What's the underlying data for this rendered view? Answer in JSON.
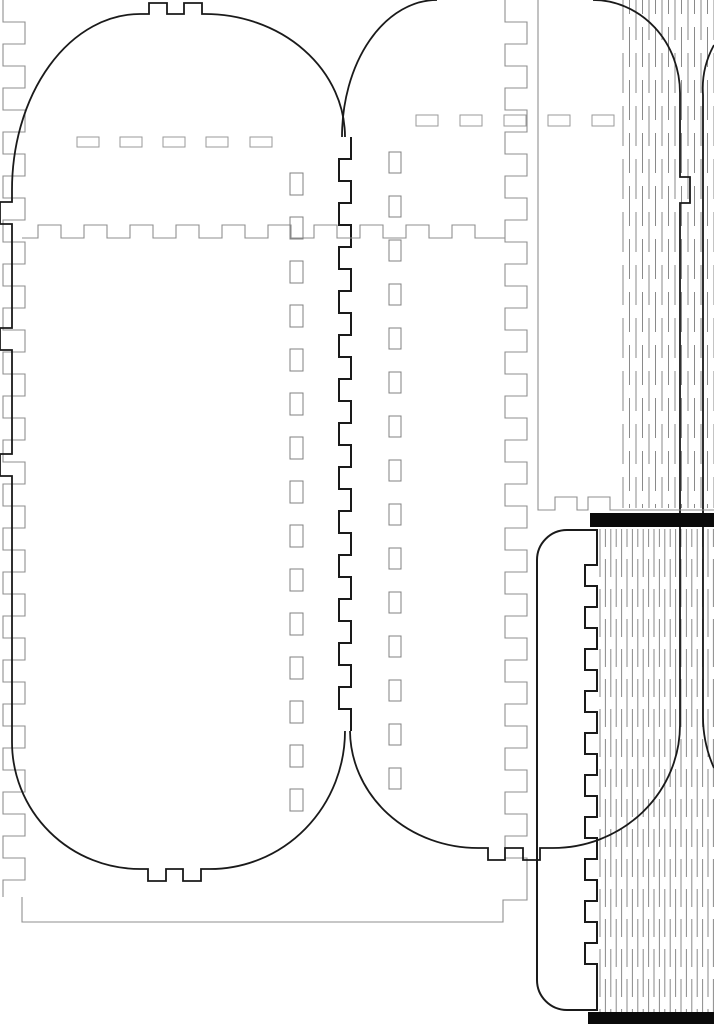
{
  "canvas": {
    "width": 714,
    "height": 1024,
    "background": "#ffffff"
  },
  "colors": {
    "cut_primary": "#1a1a1a",
    "cut_secondary": "#8f8f8f",
    "hinge_line": "#8a8a8a",
    "slot_bar_fill": "#0a0a0a"
  },
  "paths": {
    "left_stadium_top": "M12 190 A128 176 0 0 1 140 14 H149 V3 H167 V14 H184 V3 H202 V14 H205 A140 123 0 0 1 345 137",
    "left_stadium_left": "M12 190 V202 H0 V224 H12 V328 H0 V350 H12 V454 H0 V476 H12 V742",
    "left_stadium_bottom": "M345 731 A135 138 0 0 1 210 869 H201 V881 H183 V869 H166 V881 H148 V869 H140 A128 127 0 0 1 12 742",
    "center_panel": "M342 137 A95 137 0 0 1 437 0 M593 0 A87 93 0 0 1 680 93 V177 H690 V203 H680 V725 A127 123 0 0 1 553 848 H540 V860 H523 V848 H505 V860 H488 V848 H478 A128 118 0 0 1 350 731",
    "right_strip": "M714 45 A90 90 0 0 0 703 95 V717 A125 125 0 0 0 714 768",
    "upper_right_panel": "M538 0 V510 H555 V497 H577 V510 H588 V497 H610 V510 H714"
  },
  "castellations": [
    {
      "name": "shared-finger-edge",
      "type": "v",
      "pre": "M351 137",
      "xA": 351,
      "xB": 339,
      "y0": 137,
      "y1": 731,
      "seg": 22,
      "post": "",
      "cls": "cut2"
    },
    {
      "name": "base-panel-left-finger-edge",
      "type": "v",
      "pre": "M3 0",
      "xA": 3,
      "xB": 25,
      "y0": 0,
      "y1": 897,
      "seg": 22,
      "post": "",
      "cls": "cutg"
    },
    {
      "name": "base-panel-right-finger-edge",
      "type": "v",
      "pre": "M505 0",
      "xA": 505,
      "xB": 527,
      "y0": 0,
      "y1": 878,
      "seg": 22,
      "post": "V900 H503 V922 H22 V897",
      "cls": "cutg"
    },
    {
      "name": "base-panel-top-finger-edge",
      "type": "h",
      "pre": "M22 238 H38 V225",
      "yA": 225,
      "yB": 238,
      "x0": 38,
      "x1": 498,
      "seg": 23,
      "post": "H505",
      "cls": "cutg"
    },
    {
      "name": "lower-spine-panel-outline",
      "type": "v",
      "pre": "M567 530 H597 V565 H585",
      "xA": 585,
      "xB": 597,
      "y0": 565,
      "y1": 985,
      "seg": 21,
      "post": "V1010 H567 A30 30 0 0 1 537 980 V560 A30 30 0 0 1 567 530",
      "cls": "cut2"
    }
  ],
  "hinges": [
    {
      "name": "upper-living-hinge",
      "layer": "upper-hinge-layer",
      "x0": 623,
      "pitch": 6.5,
      "count": 15,
      "y0": 0,
      "y1": 508,
      "dash": 40,
      "gap": 13,
      "stagger": 26
    },
    {
      "name": "lower-living-hinge",
      "layer": "lower-hinge-layer",
      "x0": 600,
      "pitch": 5.4,
      "count": 22,
      "y0": 529,
      "y1": 1012,
      "dash": 48,
      "gap": 12,
      "stagger": 30
    }
  ],
  "slot_columns": [
    {
      "name": "left-panel-divider-slots",
      "x": 290,
      "w": 13,
      "h": 22,
      "y0": 173,
      "step": 44,
      "count": 15
    },
    {
      "name": "center-panel-divider-slots",
      "x": 389,
      "w": 12,
      "h": 21,
      "y0": 152,
      "step": 44,
      "count": 15
    }
  ],
  "dash_rows": [
    {
      "name": "left-panel-slot-row",
      "y": 137,
      "h": 10,
      "w": 22,
      "xs": [
        77,
        120,
        163,
        206,
        250
      ]
    },
    {
      "name": "center-panel-slot-row",
      "y": 115,
      "h": 11,
      "w": 22,
      "xs": [
        416,
        460,
        504,
        548,
        592
      ]
    }
  ],
  "bars": [
    {
      "name": "upper-slot-bar",
      "x": 590,
      "y": 513,
      "w": 124,
      "h": 14
    },
    {
      "name": "lower-slot-bar",
      "x": 588,
      "y": 1012,
      "w": 126,
      "h": 12
    }
  ]
}
